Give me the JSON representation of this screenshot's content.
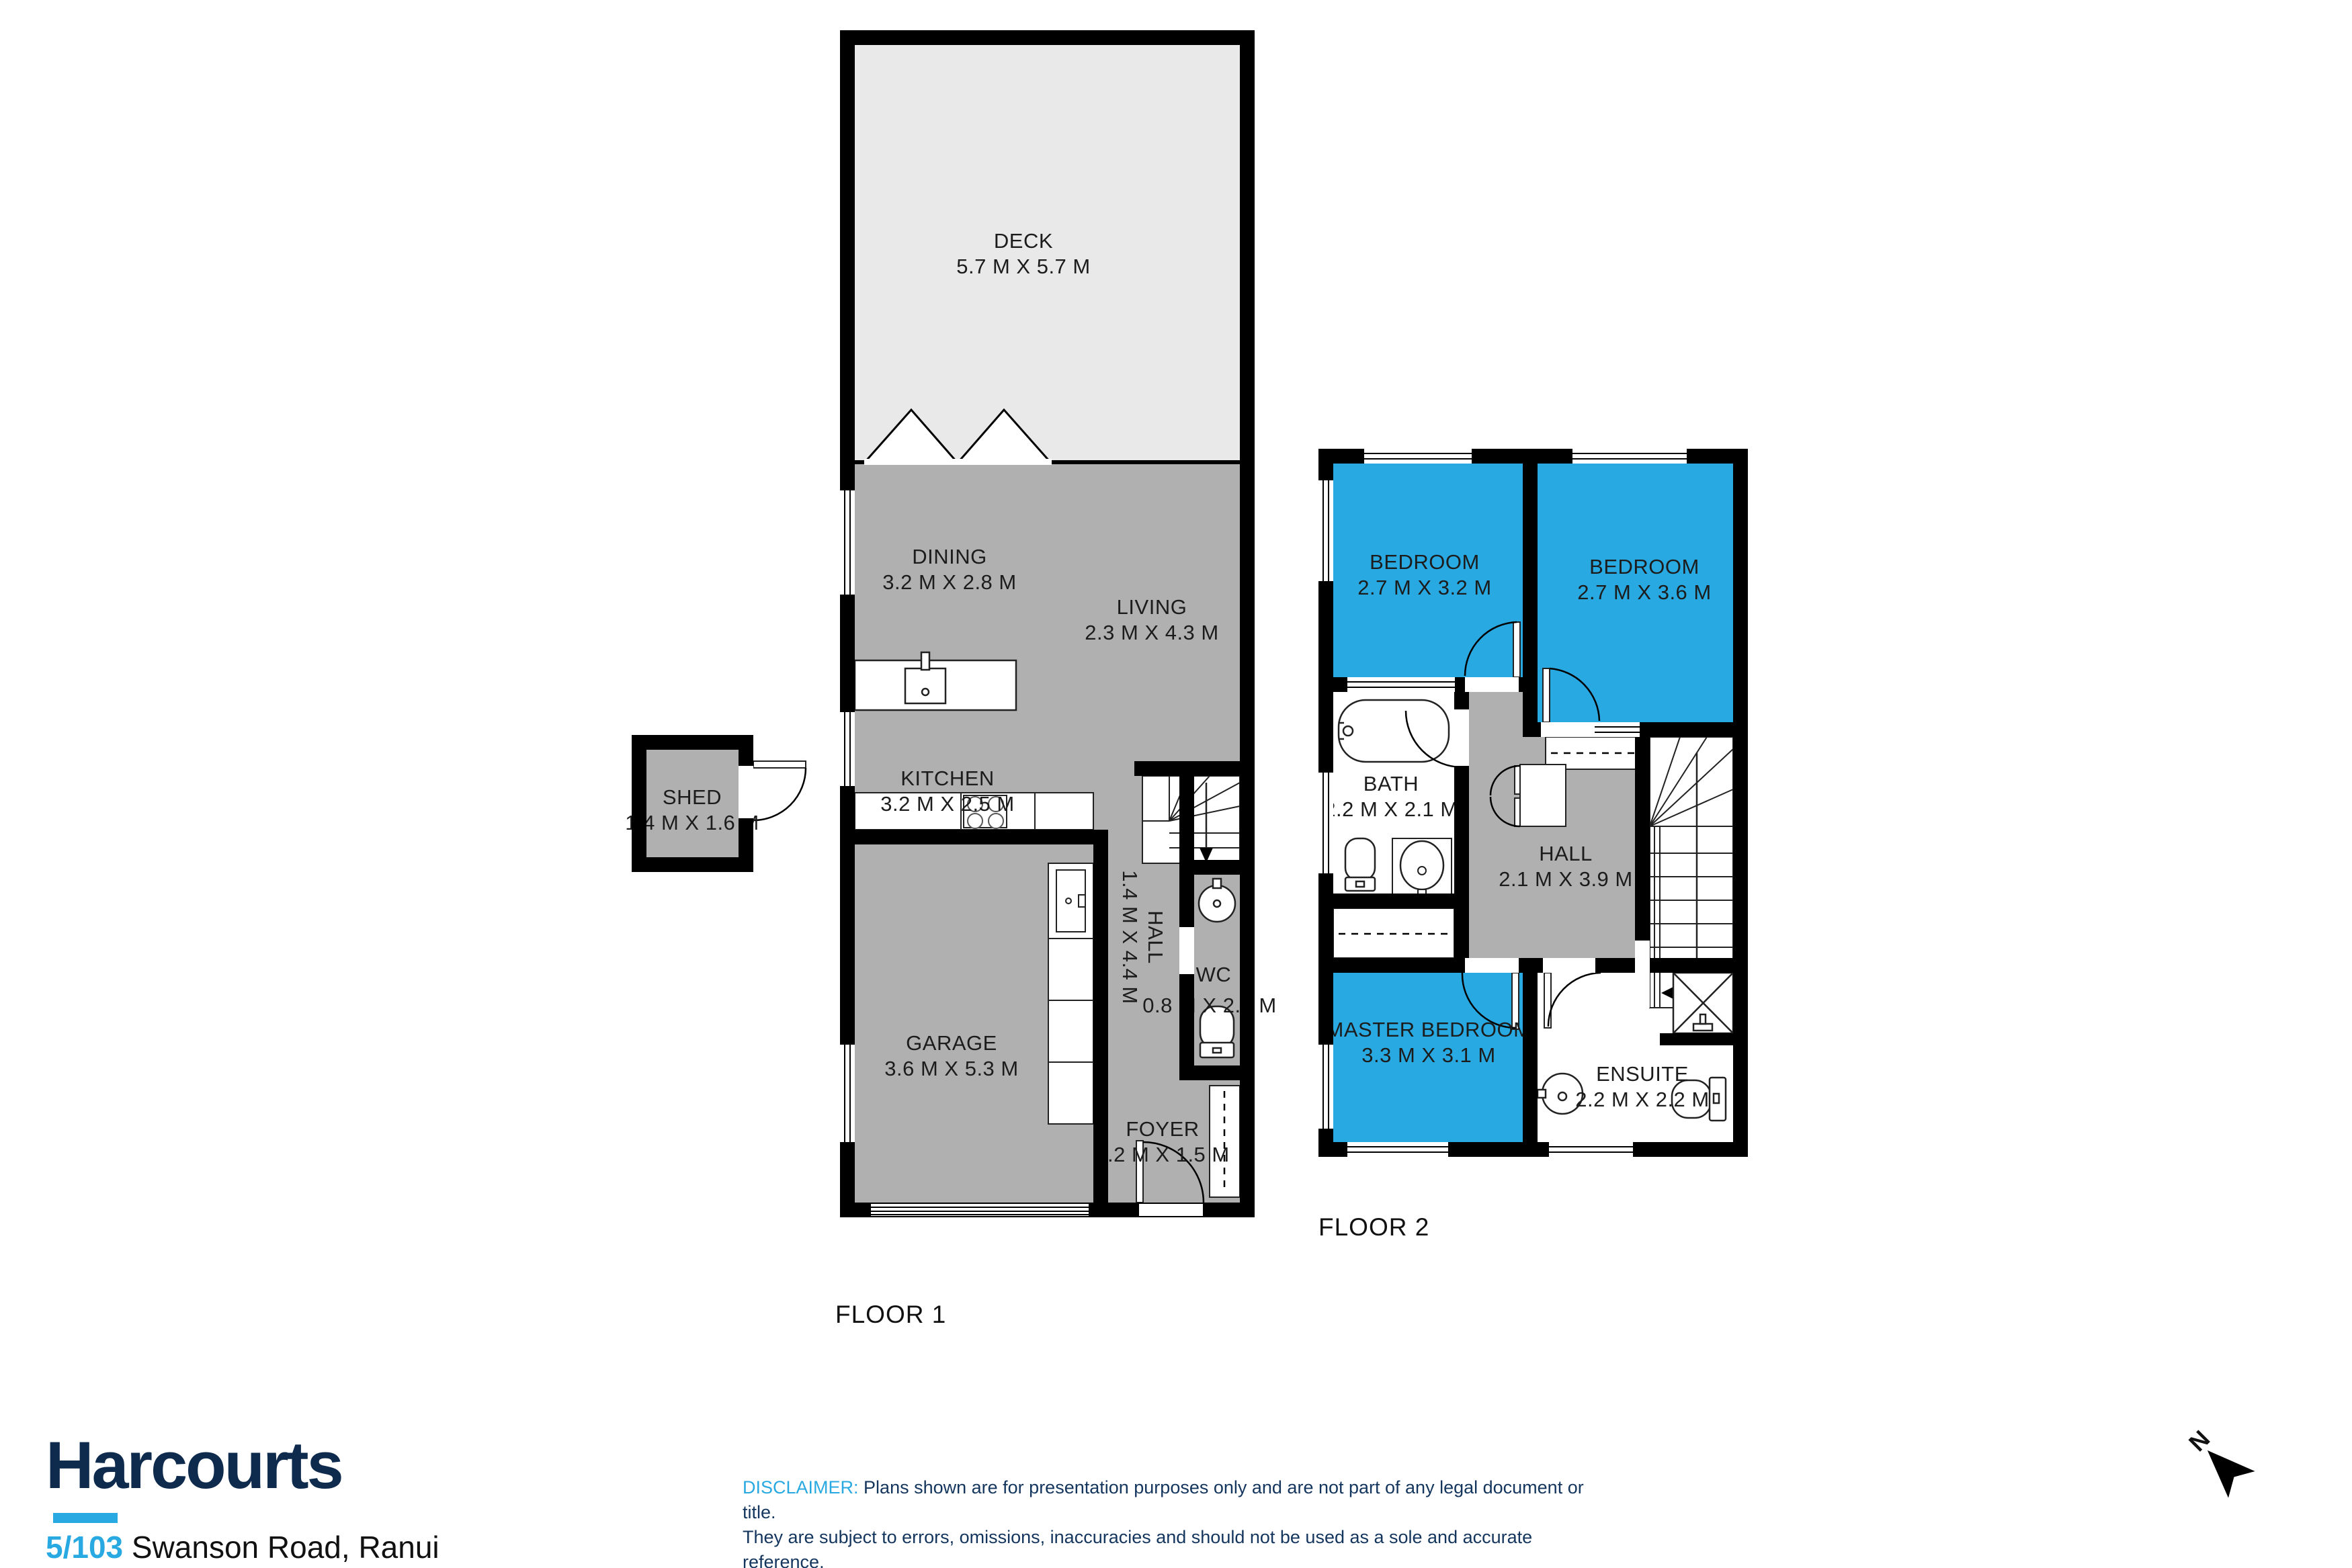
{
  "colors": {
    "accent_blue": "#29A9E1",
    "floor_gray": "#B0B0B0",
    "deck_gray": "#E9E9E9",
    "wall_black": "#000000",
    "brand_navy": "#0E2A4D",
    "disclaimer_navy": "#14365E"
  },
  "floor1": {
    "label": "FLOOR 1",
    "rooms": {
      "deck": {
        "name": "DECK",
        "dims": "5.7 M X 5.7 M"
      },
      "dining": {
        "name": "DINING",
        "dims": "3.2 M X 2.8 M"
      },
      "living": {
        "name": "LIVING",
        "dims": "2.3 M X 4.3 M"
      },
      "kitchen": {
        "name": "KITCHEN",
        "dims": "3.2 M X 2.5 M"
      },
      "shed": {
        "name": "SHED",
        "dims": "1.4 M X 1.6 M"
      },
      "garage": {
        "name": "GARAGE",
        "dims": "3.6 M X 5.3 M"
      },
      "hall": {
        "name": "HALL",
        "dims": "1.4 M X 4.4 M"
      },
      "wc": {
        "name": "WC",
        "dims": "0.8 M X 2.2 M"
      },
      "foyer": {
        "name": "FOYER",
        "dims": "1.2 M X 1.5 M"
      }
    }
  },
  "floor2": {
    "label": "FLOOR 2",
    "rooms": {
      "bedroom1": {
        "name": "BEDROOM",
        "dims": "2.7 M X 3.2 M"
      },
      "bedroom2": {
        "name": "BEDROOM",
        "dims": "2.7 M X 3.6 M"
      },
      "bath": {
        "name": "BATH",
        "dims": "2.2 M X 2.1 M"
      },
      "hall": {
        "name": "HALL",
        "dims": "2.1 M X 3.9 M"
      },
      "master": {
        "name": "MASTER BEDROOM",
        "dims": "3.3 M X 3.1 M"
      },
      "ensuite": {
        "name": "ENSUITE",
        "dims": "2.2 M X 2.2 M"
      }
    }
  },
  "branding": {
    "logo": "Harcourts",
    "address_number": "5/103",
    "address_rest": " Swanson Road, Ranui",
    "disclaimer_label": "DISCLAIMER:",
    "disclaimer_line1": " Plans shown are for presentation purposes only and are not part of any legal document or title.",
    "disclaimer_line2": "They are subject to errors, omissions, inaccuracies and should not be used as a sole and accurate reference.",
    "disclaimer_line3": "Interested parties should make their own inquiries using independent sources.",
    "north_label": "N"
  }
}
